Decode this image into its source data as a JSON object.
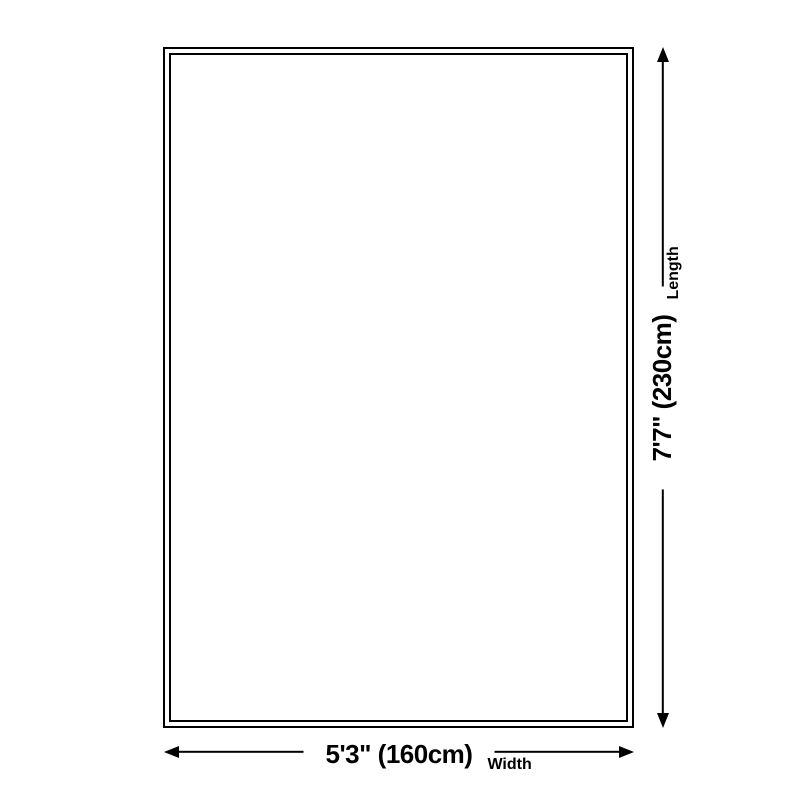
{
  "colors": {
    "background": "#ffffff",
    "outline": "#000000",
    "arrow": "#000000",
    "text": "#000000"
  },
  "diagram": {
    "width": {
      "value": "5'3\" (160cm)",
      "label": "Width"
    },
    "length": {
      "value": "7'7\" (230cm)",
      "label": "Length"
    }
  }
}
